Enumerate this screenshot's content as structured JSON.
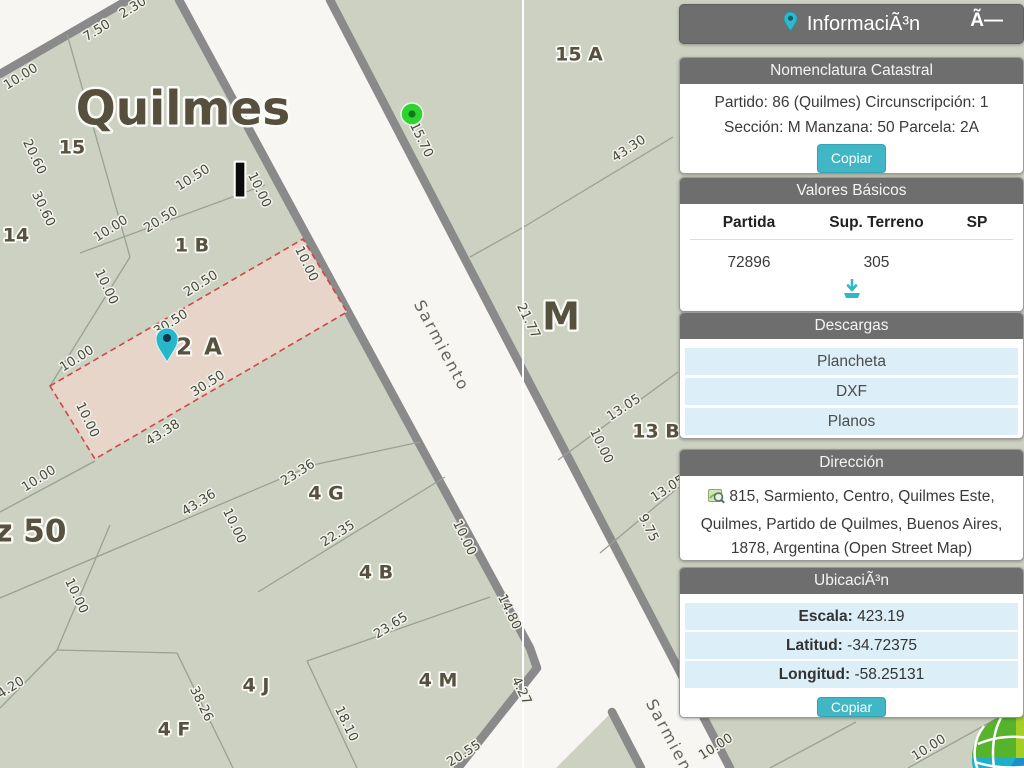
{
  "title_bar": {
    "title": "InformaciÃ³n",
    "pin_icon": "map-pin-icon",
    "close_label": "Ã—"
  },
  "nomenclatura": {
    "header": "Nomenclatura Catastral",
    "line1": "Partido: 86 (Quilmes) Circunscripción: 1",
    "line2": "Sección: M Manzana: 50 Parcela: 2A",
    "copy_label": "Copiar"
  },
  "valores": {
    "header": "Valores Básicos",
    "col_partida": "Partida",
    "col_sup": "Sup. Terreno",
    "col_sp": "SP",
    "partida": "72896",
    "sup_terreno": "305",
    "sp": "",
    "download_icon": "download-icon"
  },
  "descargas": {
    "header": "Descargas",
    "items": [
      {
        "label": "Plancheta"
      },
      {
        "label": "DXF"
      },
      {
        "label": "Planos"
      }
    ]
  },
  "direccion": {
    "header": "Dirección",
    "icon": "map-search-icon",
    "address": "815, Sarmiento, Centro, Quilmes Este, Quilmes, Partido de Quilmes, Buenos Aires, 1878, Argentina (Open Street Map)"
  },
  "ubicacion": {
    "header": "UbicaciÃ³n",
    "rows": [
      {
        "label": "Escala:",
        "value": "423.19"
      },
      {
        "label": "Latitud:",
        "value": "-34.72375"
      },
      {
        "label": "Longitud:",
        "value": "-58.25131"
      }
    ],
    "copy_label": "Copiar"
  },
  "logo": "geoportal-globe-logo",
  "map": {
    "colors": {
      "street": "#f7f6f2",
      "block": "#ccd1c1",
      "casing": "#8a8a8a",
      "line": "#9aa194",
      "white_line": "#ffffff",
      "selected_fill": "#e7d5ca",
      "selected_stroke": "#cf4747",
      "pin": "#28b7c9",
      "pin_dot": "#15344e",
      "marker": "#2fd32f",
      "marker_dot": "#0c7a1e"
    },
    "blocks": [
      "128,0 179,0 530,648 537,668 458,768 0,768 0,74",
      "330,0 1024,0 1024,768 730,768",
      "612,712 641,768 556,768"
    ],
    "casings": [
      "128,0 0,74",
      "179,0 530,648 537,668 458,768",
      "330,0 730,768",
      "612,712 641,768"
    ],
    "lines": [
      "67,34 130,257",
      "130,257 50,386",
      "80,253 265,185",
      "0,512 95,461",
      "0,598 313,465 420,442",
      "258,592 445,477",
      "307,661 490,597",
      "307,661 357,768",
      "57,650 110,525",
      "0,708 57,650",
      "57,650 177,653",
      "177,653 233,768",
      "470,257 522,228 673,137",
      "558,460 678,372",
      "600,553 680,486",
      "770,768 856,722",
      "908,768 1012,710"
    ],
    "white_lines": [
      "523,0 523,768"
    ],
    "selected_parcel": "50,386 303,239 347,312 95,459",
    "labels": [
      {
        "t": "2.30",
        "x": 133,
        "y": 8,
        "r": -32,
        "c": "dim"
      },
      {
        "t": "7.50",
        "x": 97,
        "y": 31,
        "r": -32,
        "c": "dim"
      },
      {
        "t": "10.00",
        "x": 21,
        "y": 77,
        "r": -32,
        "c": "dim"
      },
      {
        "t": "20.60",
        "x": 34,
        "y": 157,
        "r": 64,
        "c": "dim"
      },
      {
        "t": "30.60",
        "x": 43,
        "y": 209,
        "r": 64,
        "c": "dim"
      },
      {
        "t": "10.50",
        "x": 193,
        "y": 178,
        "r": -32,
        "c": "dim"
      },
      {
        "t": "10.00",
        "x": 259,
        "y": 190,
        "r": 64,
        "c": "dim"
      },
      {
        "t": "20.50",
        "x": 161,
        "y": 220,
        "r": -32,
        "c": "dim"
      },
      {
        "t": "10.00",
        "x": 111,
        "y": 229,
        "r": -32,
        "c": "dim"
      },
      {
        "t": "10.00",
        "x": 306,
        "y": 264,
        "r": 64,
        "c": "dim"
      },
      {
        "t": "20.50",
        "x": 201,
        "y": 284,
        "r": -32,
        "c": "dim"
      },
      {
        "t": "30.50",
        "x": 171,
        "y": 323,
        "r": -32,
        "c": "dim"
      },
      {
        "t": "10.00",
        "x": 106,
        "y": 287,
        "r": 64,
        "c": "dim"
      },
      {
        "t": "10.00",
        "x": 77,
        "y": 359,
        "r": -32,
        "c": "dim"
      },
      {
        "t": "10.00",
        "x": 87,
        "y": 420,
        "r": 64,
        "c": "dim"
      },
      {
        "t": "30.50",
        "x": 208,
        "y": 384,
        "r": -32,
        "c": "dim"
      },
      {
        "t": "43.38",
        "x": 163,
        "y": 433,
        "r": -32,
        "c": "dim"
      },
      {
        "t": "10.00",
        "x": 39,
        "y": 479,
        "r": -32,
        "c": "dim"
      },
      {
        "t": "43.36",
        "x": 199,
        "y": 503,
        "r": -32,
        "c": "dim"
      },
      {
        "t": "23.36",
        "x": 298,
        "y": 473,
        "r": -32,
        "c": "dim"
      },
      {
        "t": "10.00",
        "x": 234,
        "y": 526,
        "r": 64,
        "c": "dim"
      },
      {
        "t": "22.35",
        "x": 338,
        "y": 534,
        "r": -32,
        "c": "dim"
      },
      {
        "t": "10.00",
        "x": 76,
        "y": 596,
        "r": 64,
        "c": "dim"
      },
      {
        "t": "4.20",
        "x": 11,
        "y": 688,
        "r": -32,
        "c": "dim"
      },
      {
        "t": "38.26",
        "x": 201,
        "y": 704,
        "r": 64,
        "c": "dim"
      },
      {
        "t": "10.00",
        "x": 464,
        "y": 538,
        "r": 64,
        "c": "dim"
      },
      {
        "t": "23.65",
        "x": 391,
        "y": 626,
        "r": -32,
        "c": "dim"
      },
      {
        "t": "14.80",
        "x": 509,
        "y": 612,
        "r": 64,
        "c": "dim"
      },
      {
        "t": "18.10",
        "x": 346,
        "y": 724,
        "r": 64,
        "c": "dim"
      },
      {
        "t": "20.55",
        "x": 464,
        "y": 754,
        "r": -32,
        "c": "dim"
      },
      {
        "t": "4.27",
        "x": 521,
        "y": 691,
        "r": 64,
        "c": "dim"
      },
      {
        "t": "15.70",
        "x": 421,
        "y": 140,
        "r": 64,
        "c": "dim"
      },
      {
        "t": "43.30",
        "x": 629,
        "y": 149,
        "r": -33,
        "c": "dim"
      },
      {
        "t": "21.77",
        "x": 528,
        "y": 321,
        "r": 64,
        "c": "dim"
      },
      {
        "t": "13.05",
        "x": 624,
        "y": 408,
        "r": -33,
        "c": "dim"
      },
      {
        "t": "10.00",
        "x": 601,
        "y": 446,
        "r": 64,
        "c": "dim"
      },
      {
        "t": "13.05",
        "x": 668,
        "y": 489,
        "r": -33,
        "c": "dim"
      },
      {
        "t": "9.75",
        "x": 648,
        "y": 528,
        "r": 64,
        "c": "dim"
      },
      {
        "t": "10.00",
        "x": 716,
        "y": 747,
        "r": -32,
        "c": "dim"
      },
      {
        "t": "10.00",
        "x": 929,
        "y": 748,
        "r": -32,
        "c": "dim"
      },
      {
        "t": "15",
        "x": 72,
        "y": 148,
        "r": 0,
        "c": "parcel"
      },
      {
        "t": "14",
        "x": 16,
        "y": 236,
        "r": 0,
        "c": "parcel"
      },
      {
        "t": "1 B",
        "x": 192,
        "y": 246,
        "r": 0,
        "c": "parcel"
      },
      {
        "t": "2 A",
        "x": 200,
        "y": 348,
        "r": 0,
        "c": "parcel-lg"
      },
      {
        "t": "15 A",
        "x": 579,
        "y": 55,
        "r": 0,
        "c": "parcel"
      },
      {
        "t": "M",
        "x": 561,
        "y": 319,
        "r": 0,
        "c": "mletter"
      },
      {
        "t": "13 B",
        "x": 656,
        "y": 432,
        "r": 0,
        "c": "parcel"
      },
      {
        "t": "4 G",
        "x": 326,
        "y": 494,
        "r": 0,
        "c": "parcel"
      },
      {
        "t": "4 B",
        "x": 376,
        "y": 573,
        "r": 0,
        "c": "parcel"
      },
      {
        "t": "4 M",
        "x": 438,
        "y": 681,
        "r": 0,
        "c": "parcel"
      },
      {
        "t": "4 J",
        "x": 256,
        "y": 686,
        "r": 0,
        "c": "parcel"
      },
      {
        "t": "4 F",
        "x": 174,
        "y": 730,
        "r": 0,
        "c": "parcel"
      },
      {
        "t": "Mz 50",
        "x": 15,
        "y": 533,
        "r": 0,
        "c": "mz"
      },
      {
        "t": "Quilmes",
        "x": 183,
        "y": 112,
        "r": 0,
        "c": "huge"
      },
      {
        "t": "I",
        "x": 240,
        "y": 184,
        "r": 0,
        "c": "ibar"
      },
      {
        "t": "Sarmiento",
        "x": 441,
        "y": 346,
        "r": 62,
        "c": "street"
      },
      {
        "t": "Sarmiento",
        "x": 673,
        "y": 745,
        "r": 62,
        "c": "street"
      }
    ],
    "markers": {
      "green": {
        "x": 412,
        "y": 114
      },
      "pin": {
        "x": 167,
        "y": 362
      }
    }
  }
}
